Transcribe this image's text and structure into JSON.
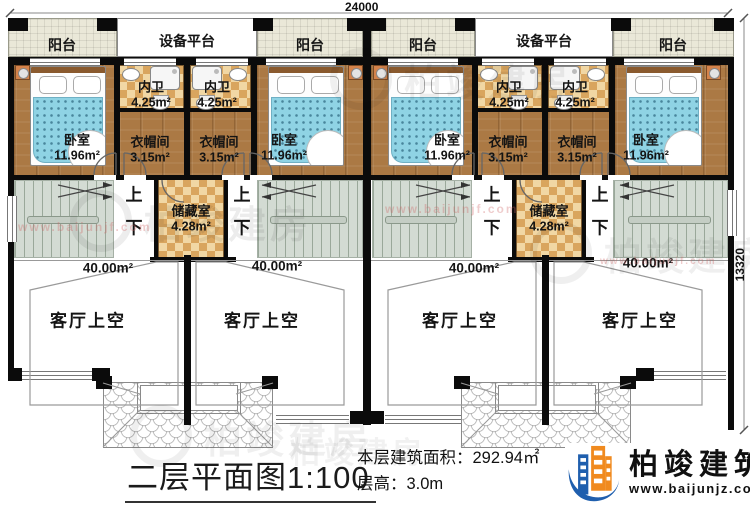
{
  "dimensions": {
    "width": "24000",
    "height": "13320"
  },
  "labels": {
    "balcony": "阳台",
    "platform": "设备平台",
    "bedroom": "卧室",
    "bath": "内卫",
    "closet": "衣帽间",
    "storage": "储藏室",
    "living_void": "客厅上空",
    "up": "上",
    "down": "下"
  },
  "areas": {
    "bedroom": "11.96m²",
    "bath": "4.25m²",
    "closet": "3.15m²",
    "storage": "4.28m²",
    "living_void": "40.00m²"
  },
  "title": {
    "text": "二层平面图",
    "scale": "1:100"
  },
  "info": {
    "floor_area": "本层建筑面积：292.94㎡",
    "floor_height": "层高：3.0m"
  },
  "logo": {
    "name": "柏竣建筑",
    "website": "www.baijunjz.com"
  },
  "watermark": {
    "brand": "柏竣建房",
    "website": "www.baijunjf.com"
  },
  "colors": {
    "wall": "#0b0b0b",
    "wood": "#ab7944",
    "bed": "#8fd3e4",
    "checker": "#d9a55e",
    "logo_blue": "#1f5fae",
    "logo_orange": "#f08a1f"
  }
}
